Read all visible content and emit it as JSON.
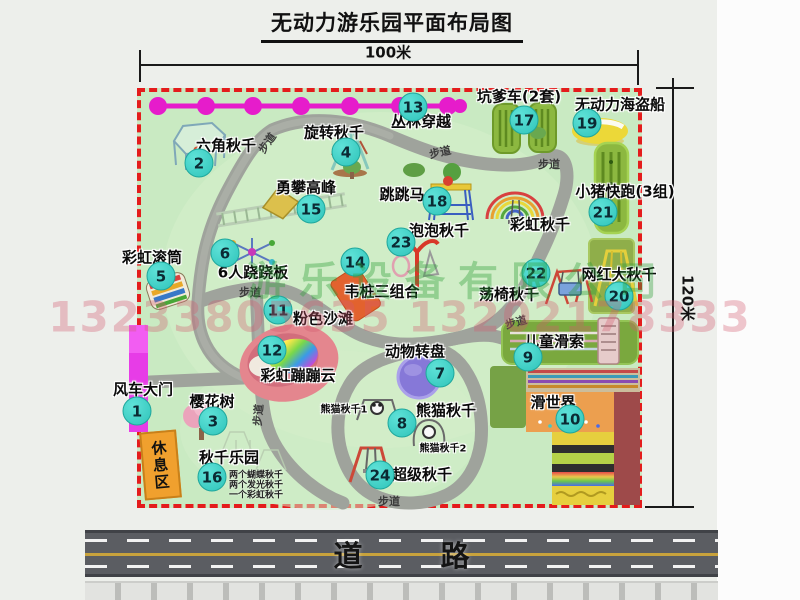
{
  "title": "无动力游乐园平面布局图",
  "dimensions": {
    "width": "100米",
    "height": "120米"
  },
  "road_label": "道 路",
  "rest_area_label": "休息区",
  "path_label": "步道",
  "watermarks": {
    "company": "游乐设备有限公司",
    "phone": "13233805635 13202178333"
  },
  "extra_labels": {
    "rainbow_swing": "彩虹秋千",
    "panda_swing_1": "熊猫秋千1",
    "panda_swing_2": "熊猫秋千2"
  },
  "swing_park_notes": [
    "两个蝴蝶秋千",
    "两个发光秋千",
    "一个彩虹秋千"
  ],
  "items": [
    {
      "num": "1",
      "label": "风车大门"
    },
    {
      "num": "2",
      "label": "六角秋千"
    },
    {
      "num": "3",
      "label": "樱花树"
    },
    {
      "num": "4",
      "label": "旋转秋千"
    },
    {
      "num": "5",
      "label": "彩虹滚筒"
    },
    {
      "num": "6",
      "label": "6人跷跷板"
    },
    {
      "num": "7",
      "label": "动物转盘"
    },
    {
      "num": "8",
      "label": "熊猫秋千"
    },
    {
      "num": "9",
      "label": "儿童滑索"
    },
    {
      "num": "10",
      "label": "滑世界"
    },
    {
      "num": "11",
      "label": "粉色沙滩"
    },
    {
      "num": "12",
      "label": "彩虹蹦蹦云"
    },
    {
      "num": "13",
      "label": "丛林穿越"
    },
    {
      "num": "14",
      "label": "韦桩三组合"
    },
    {
      "num": "15",
      "label": "勇攀高峰"
    },
    {
      "num": "16",
      "label": "秋千乐园"
    },
    {
      "num": "17",
      "label": "坑爹车(2套)"
    },
    {
      "num": "18",
      "label": "跳跳马"
    },
    {
      "num": "19",
      "label": "无动力海盗船"
    },
    {
      "num": "20",
      "label": "网红大秋千"
    },
    {
      "num": "21",
      "label": "小猪快跑(3组)"
    },
    {
      "num": "22",
      "label": "荡椅秋千"
    },
    {
      "num": "23",
      "label": "泡泡秋千"
    },
    {
      "num": "24",
      "label": "超级秋千"
    }
  ],
  "colors": {
    "map_green": "#c9eac2",
    "border_red": "#e41c1c",
    "badge_teal": "#3bd3c6",
    "gate_magenta": "#e73ce7",
    "zipline_magenta": "#e61ccb",
    "road_gray": "#5b5d62"
  }
}
